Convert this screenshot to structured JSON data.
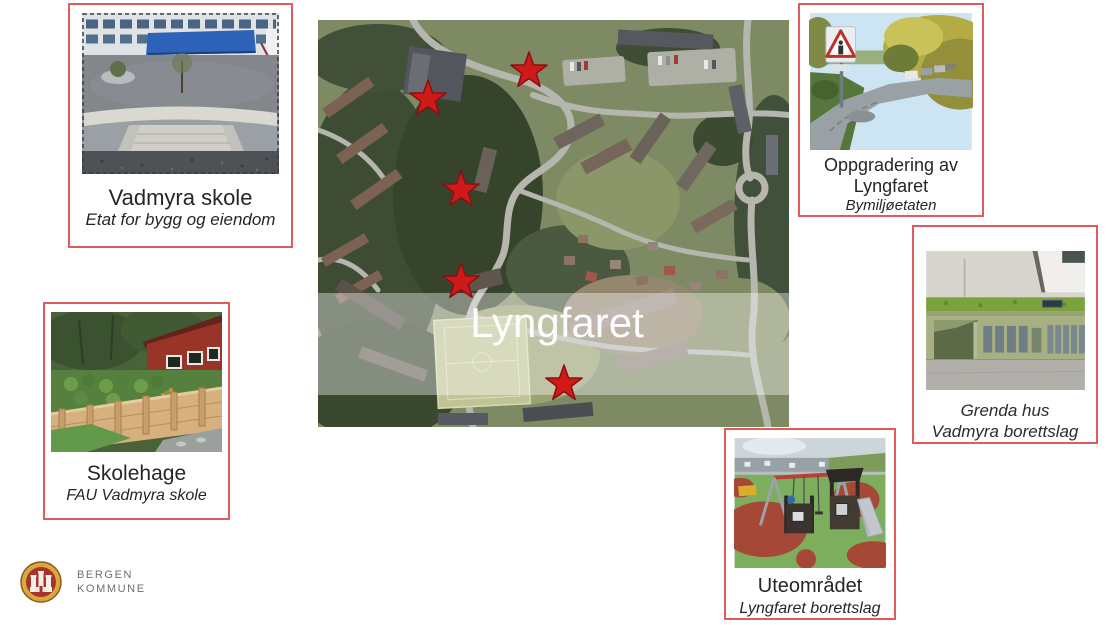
{
  "map": {
    "label": "Lyngfaret",
    "label_color": "#ffffff",
    "band_opacity": 0.38,
    "star_fill": "#d01a1a",
    "star_stroke": "#8b0f0f",
    "star_size": 40,
    "stars": [
      {
        "x": 211,
        "y": 51
      },
      {
        "x": 110,
        "y": 79
      },
      {
        "x": 143,
        "y": 170
      },
      {
        "x": 143,
        "y": 262
      },
      {
        "x": 246,
        "y": 364
      }
    ]
  },
  "cards": [
    {
      "id": "vadmyra-skole",
      "title": "Vadmyra skole",
      "subtitle": "Etat for bygg og eiendom"
    },
    {
      "id": "skolehage",
      "title": "Skolehage",
      "subtitle": "FAU Vadmyra skole"
    },
    {
      "id": "oppgradering-lyngfaret",
      "title": "Oppgradering av Lyngfaret",
      "subtitle": "Bymiljøetaten"
    },
    {
      "id": "grenda-hus",
      "caption_line1": "Grenda hus",
      "caption_line2": "Vadmyra borettslag"
    },
    {
      "id": "uteomradet",
      "title": "Uteområdet",
      "subtitle": "Lyngfaret borettslag"
    }
  ],
  "logo": {
    "line1": "BERGEN",
    "line2": "KOMMUNE"
  },
  "colors": {
    "card_border": "#e05c5c",
    "map_band": "#ffffff",
    "logo_gold": "#d9a93c",
    "logo_red": "#a8332d",
    "logo_text": "#6f6f6f"
  }
}
